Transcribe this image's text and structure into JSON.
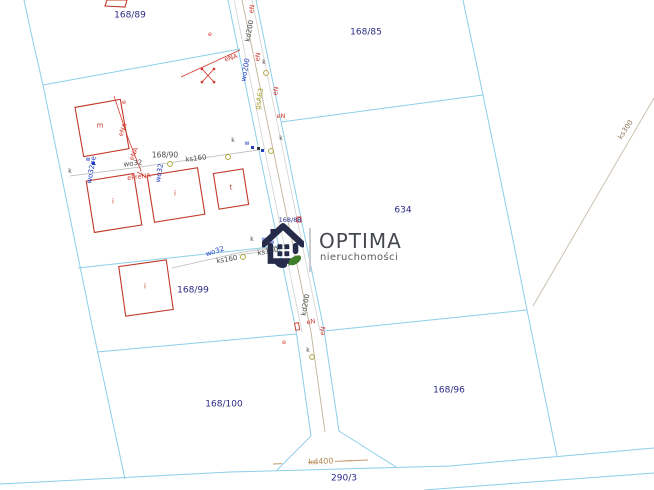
{
  "map": {
    "parcels": {
      "p168_89": "168/89",
      "p168_85": "168/85",
      "p168_88": "168/88",
      "p634": "634",
      "p168_90": "168/90",
      "p168_99": "168/99",
      "p168_100": "168/100",
      "p168_96": "168/96",
      "p290_3": "290/3"
    },
    "utilities": {
      "kd200": "kd200",
      "wo200": "wo200",
      "gsA63": "gsA63",
      "ks160": "ks160",
      "wo32": "wo32",
      "wo32pe": "wo32pe",
      "ks300": "ks300",
      "kd400": "kd400"
    },
    "power": {
      "eNA": "eNA",
      "ePreNA": "ePreNA",
      "eN": "eN",
      "e": "e"
    },
    "markers": {
      "k": "k",
      "w": "w"
    },
    "buildings": {
      "m": "m",
      "i": "i",
      "t": "t"
    },
    "colors": {
      "parcel_line": "#8ccfe9",
      "building_outline": "#c0392b",
      "power_line": "#d23b2f",
      "water_label": "#2440c0",
      "gas_label": "#a59a28",
      "sewer_label": "#8a795d",
      "storm_label": "#b58a50",
      "parcel_label": "#2b2a85",
      "logo_navy": "#252b49",
      "logo_green": "#3e7d2c"
    }
  },
  "logo": {
    "title": "OPTIMA",
    "subtitle": "nieruchomości"
  }
}
